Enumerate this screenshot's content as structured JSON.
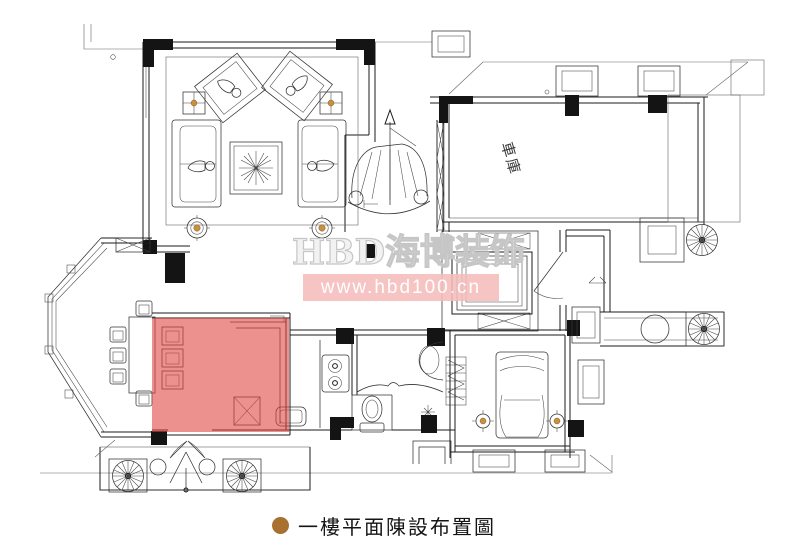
{
  "watermark": {
    "brand": "HBD海博装饰",
    "url": "www.hbd100.cn"
  },
  "caption": {
    "text": "一樓平面陳設布置圖"
  },
  "plan": {
    "garage_label": "車庫"
  },
  "colors": {
    "highlight": "#E0423E",
    "watermark_bar": "#F4BDBB",
    "watermark_text": "#FFFFFF",
    "watermark_brand_outline": "#C6C6C6",
    "bullet": "#A9712F",
    "accent_dot": "#C9913E",
    "line": "#1B1B1B"
  }
}
